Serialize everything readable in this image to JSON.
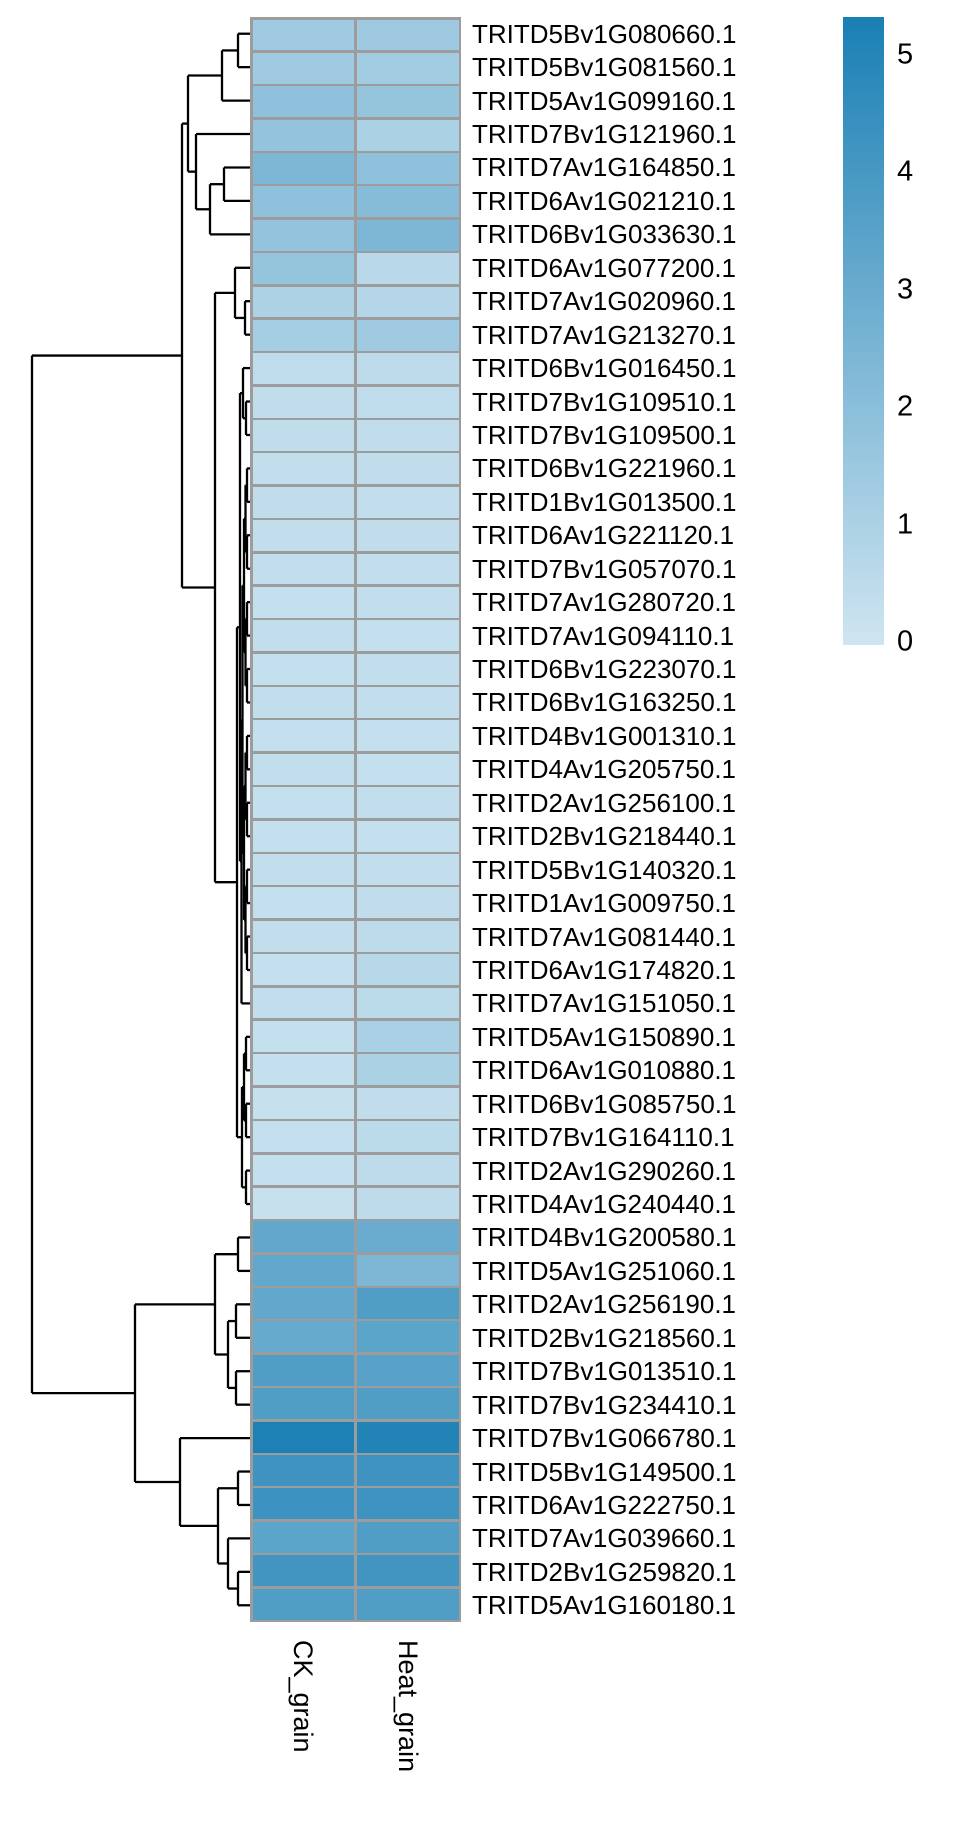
{
  "chart_data": {
    "type": "heatmap",
    "title": "",
    "columns": [
      "CK_grain",
      "Heat_grain"
    ],
    "rows": [
      {
        "gene": "TRITD5Bv1G080660.1",
        "values": [
          1.3,
          1.35
        ]
      },
      {
        "gene": "TRITD5Bv1G081560.1",
        "values": [
          1.3,
          1.25
        ]
      },
      {
        "gene": "TRITD5Av1G099160.1",
        "values": [
          1.75,
          1.6
        ]
      },
      {
        "gene": "TRITD7Bv1G121960.1",
        "values": [
          1.65,
          1.0
        ]
      },
      {
        "gene": "TRITD7Av1G164850.1",
        "values": [
          2.25,
          1.75
        ]
      },
      {
        "gene": "TRITD6Av1G021210.1",
        "values": [
          1.75,
          2.0
        ]
      },
      {
        "gene": "TRITD6Bv1G033630.1",
        "values": [
          1.65,
          2.25
        ]
      },
      {
        "gene": "TRITD6Av1G077200.1",
        "values": [
          1.6,
          0.6
        ]
      },
      {
        "gene": "TRITD7Av1G020960.1",
        "values": [
          0.95,
          0.75
        ]
      },
      {
        "gene": "TRITD7Av1G213270.1",
        "values": [
          1.15,
          1.3
        ]
      },
      {
        "gene": "TRITD6Bv1G016450.1",
        "values": [
          0.45,
          0.5
        ]
      },
      {
        "gene": "TRITD7Bv1G109510.1",
        "values": [
          0.4,
          0.45
        ]
      },
      {
        "gene": "TRITD7Bv1G109500.1",
        "values": [
          0.4,
          0.4
        ]
      },
      {
        "gene": "TRITD6Bv1G221960.1",
        "values": [
          0.35,
          0.4
        ]
      },
      {
        "gene": "TRITD1Bv1G013500.1",
        "values": [
          0.4,
          0.35
        ]
      },
      {
        "gene": "TRITD6Av1G221120.1",
        "values": [
          0.35,
          0.4
        ]
      },
      {
        "gene": "TRITD7Bv1G057070.1",
        "values": [
          0.35,
          0.35
        ]
      },
      {
        "gene": "TRITD7Av1G280720.1",
        "values": [
          0.3,
          0.35
        ]
      },
      {
        "gene": "TRITD7Av1G094110.1",
        "values": [
          0.35,
          0.3
        ]
      },
      {
        "gene": "TRITD6Bv1G223070.1",
        "values": [
          0.3,
          0.35
        ]
      },
      {
        "gene": "TRITD6Bv1G163250.1",
        "values": [
          0.35,
          0.35
        ]
      },
      {
        "gene": "TRITD4Bv1G001310.1",
        "values": [
          0.3,
          0.3
        ]
      },
      {
        "gene": "TRITD4Av1G205750.1",
        "values": [
          0.35,
          0.3
        ]
      },
      {
        "gene": "TRITD2Av1G256100.1",
        "values": [
          0.3,
          0.35
        ]
      },
      {
        "gene": "TRITD2Bv1G218440.1",
        "values": [
          0.3,
          0.3
        ]
      },
      {
        "gene": "TRITD5Bv1G140320.1",
        "values": [
          0.35,
          0.35
        ]
      },
      {
        "gene": "TRITD1Av1G009750.1",
        "values": [
          0.3,
          0.4
        ]
      },
      {
        "gene": "TRITD7Av1G081440.1",
        "values": [
          0.35,
          0.5
        ]
      },
      {
        "gene": "TRITD6Av1G174820.1",
        "values": [
          0.3,
          0.65
        ]
      },
      {
        "gene": "TRITD7Av1G151050.1",
        "values": [
          0.35,
          0.55
        ]
      },
      {
        "gene": "TRITD5Av1G150890.1",
        "values": [
          0.3,
          1.05
        ]
      },
      {
        "gene": "TRITD6Av1G010880.1",
        "values": [
          0.3,
          1.0
        ]
      },
      {
        "gene": "TRITD6Bv1G085750.1",
        "values": [
          0.25,
          0.4
        ]
      },
      {
        "gene": "TRITD7Bv1G164110.1",
        "values": [
          0.3,
          0.55
        ]
      },
      {
        "gene": "TRITD2Av1G290260.1",
        "values": [
          0.3,
          0.5
        ]
      },
      {
        "gene": "TRITD4Av1G240440.1",
        "values": [
          0.25,
          0.5
        ]
      },
      {
        "gene": "TRITD4Bv1G200580.1",
        "values": [
          3.0,
          2.8
        ]
      },
      {
        "gene": "TRITD5Av1G251060.1",
        "values": [
          3.0,
          2.25
        ]
      },
      {
        "gene": "TRITD2Av1G256190.1",
        "values": [
          3.0,
          3.5
        ]
      },
      {
        "gene": "TRITD2Bv1G218560.1",
        "values": [
          2.9,
          3.2
        ]
      },
      {
        "gene": "TRITD7Bv1G013510.1",
        "values": [
          3.5,
          3.3
        ]
      },
      {
        "gene": "TRITD7Bv1G234410.1",
        "values": [
          3.5,
          3.5
        ]
      },
      {
        "gene": "TRITD7Bv1G066780.1",
        "values": [
          4.9,
          4.8
        ]
      },
      {
        "gene": "TRITD5Bv1G149500.1",
        "values": [
          4.0,
          4.0
        ]
      },
      {
        "gene": "TRITD6Av1G222750.1",
        "values": [
          4.05,
          4.0
        ]
      },
      {
        "gene": "TRITD7Av1G039660.1",
        "values": [
          3.2,
          3.5
        ]
      },
      {
        "gene": "TRITD2Bv1G259820.1",
        "values": [
          3.9,
          3.9
        ]
      },
      {
        "gene": "TRITD5Av1G160180.1",
        "values": [
          3.5,
          3.5
        ]
      }
    ],
    "legend": {
      "ticks": [
        "5",
        "4",
        "3",
        "2",
        "1",
        "0"
      ],
      "position": "right"
    },
    "color_scale": {
      "min": 0,
      "max": 5,
      "low_color": "#cfe5f1",
      "high_color": "#1a7fb4"
    },
    "grid_color": "#9c9c9c",
    "dendrogram_color": "#000000",
    "row_dendrogram": {
      "h": 32,
      "c": [
        {
          "h": 182,
          "c": [
            {
              "h": 188,
              "c": [
                {
                  "h": 222,
                  "c": [
                    {
                      "h": 238,
                      "c": [
                        0,
                        1
                      ]
                    },
                    2
                  ]
                },
                {
                  "h": 196,
                  "c": [
                    3,
                    {
                      "h": 210,
                      "c": [
                        {
                          "h": 224,
                          "c": [
                            4,
                            5
                          ]
                        },
                        6
                      ]
                    }
                  ]
                }
              ]
            },
            {
              "h": 215,
              "c": [
                {
                  "h": 235,
                  "c": [
                    7,
                    {
                      "h": 245,
                      "c": [
                        8,
                        9
                      ]
                    }
                  ]
                },
                {
                  "h": 237,
                  "c": [
                    {
                      "h": 240,
                      "c": [
                        {
                          "h": 243,
                          "c": [
                            10,
                            {
                              "h": 246,
                              "c": [
                                11,
                                12
                              ]
                            }
                          ]
                        },
                        {
                          "h": 241.5,
                          "c": [
                            {
                              "h": 242.5,
                              "c": [
                                {
                                  "h": 244,
                                  "c": [
                                    {
                                      "h": 245.5,
                                      "c": [
                                        {
                                          "h": 247,
                                          "c": [
                                            13,
                                            14
                                          ]
                                        },
                                        {
                                          "h": 247,
                                          "c": [
                                            15,
                                            16
                                          ]
                                        }
                                      ]
                                    },
                                    {
                                      "h": 245.5,
                                      "c": [
                                        {
                                          "h": 247,
                                          "c": [
                                            17,
                                            18
                                          ]
                                        },
                                        {
                                          "h": 247,
                                          "c": [
                                            19,
                                            20
                                          ]
                                        }
                                      ]
                                    }
                                  ]
                                },
                                {
                                  "h": 244,
                                  "c": [
                                    {
                                      "h": 245.5,
                                      "c": [
                                        {
                                          "h": 247,
                                          "c": [
                                            21,
                                            22
                                          ]
                                        },
                                        {
                                          "h": 247,
                                          "c": [
                                            23,
                                            24
                                          ]
                                        }
                                      ]
                                    },
                                    {
                                      "h": 245.5,
                                      "c": [
                                        {
                                          "h": 247,
                                          "c": [
                                            25,
                                            26
                                          ]
                                        },
                                        {
                                          "h": 247,
                                          "c": [
                                            27,
                                            28
                                          ]
                                        }
                                      ]
                                    }
                                  ]
                                }
                              ]
                            },
                            29
                          ]
                        }
                      ]
                    },
                    {
                      "h": 242,
                      "c": [
                        {
                          "h": 244,
                          "c": [
                            {
                              "h": 246,
                              "c": [
                                30,
                                31
                              ]
                            },
                            {
                              "h": 246,
                              "c": [
                                32,
                                33
                              ]
                            }
                          ]
                        },
                        {
                          "h": 246,
                          "c": [
                            34,
                            35
                          ]
                        }
                      ]
                    }
                  ]
                }
              ]
            }
          ]
        },
        {
          "h": 135,
          "c": [
            {
              "h": 215,
              "c": [
                {
                  "h": 238,
                  "c": [
                    36,
                    37
                  ]
                },
                {
                  "h": 228,
                  "c": [
                    {
                      "h": 236,
                      "c": [
                        38,
                        39
                      ]
                    },
                    {
                      "h": 236,
                      "c": [
                        40,
                        41
                      ]
                    }
                  ]
                }
              ]
            },
            {
              "h": 180,
              "c": [
                42,
                {
                  "h": 218,
                  "c": [
                    {
                      "h": 238,
                      "c": [
                        43,
                        44
                      ]
                    },
                    {
                      "h": 228,
                      "c": [
                        45,
                        {
                          "h": 238,
                          "c": [
                            46,
                            47
                          ]
                        }
                      ]
                    }
                  ]
                }
              ]
            }
          ]
        }
      ]
    }
  }
}
